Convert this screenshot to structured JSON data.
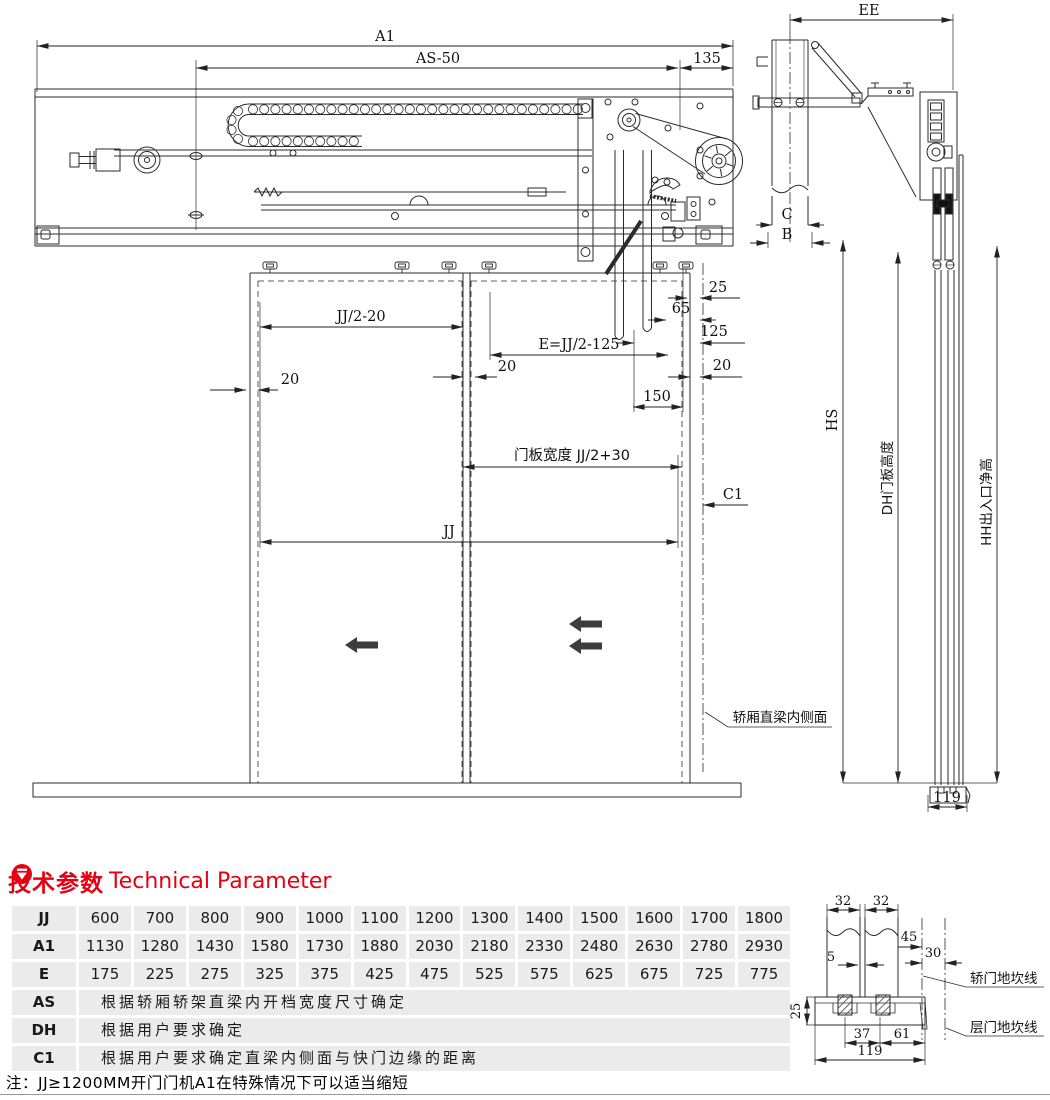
{
  "diagram": {
    "front": {
      "a1": "A1",
      "as_minus_50": "AS-50",
      "n135": "135",
      "jj_half_minus_20": "JJ/2-20",
      "e_formula": "E=JJ/2-125",
      "n25": "25",
      "n65": "65",
      "n125": "125",
      "n20": "20",
      "n150": "150",
      "door_panel_width": "门板宽度 JJ/2+30",
      "c1": "C1",
      "jj": "JJ",
      "car_beam_inner_face": "轿厢直梁内侧面"
    },
    "side": {
      "ee": "EE",
      "c": "C",
      "b": "B",
      "hs": "HS",
      "dh_door_height": "DH门板高度",
      "hh_clear_height": "HH出入口净高",
      "n119": "119"
    },
    "sill": {
      "n32": "32",
      "n45": "45",
      "n30": "30",
      "n5": "5",
      "n25": "25",
      "n37": "37",
      "n61": "61",
      "n119": "119",
      "car_sill_line": "轿门地坎线",
      "landing_sill_line": "层门地坎线"
    }
  },
  "params": {
    "title_zh": "技术参数",
    "title_en": "Technical Parameter",
    "accent_color": "#e60012",
    "note": "注：JJ≥1200MM开门门机A1在特殊情况下可以适当缩短",
    "numeric_rows": [
      {
        "label": "JJ",
        "values": [
          "600",
          "700",
          "800",
          "900",
          "1000",
          "1100",
          "1200",
          "1300",
          "1400",
          "1500",
          "1600",
          "1700",
          "1800"
        ]
      },
      {
        "label": "A1",
        "values": [
          "1130",
          "1280",
          "1430",
          "1580",
          "1730",
          "1880",
          "2030",
          "2180",
          "2330",
          "2480",
          "2630",
          "2780",
          "2930"
        ]
      },
      {
        "label": "E",
        "values": [
          "175",
          "225",
          "275",
          "325",
          "375",
          "425",
          "475",
          "525",
          "575",
          "625",
          "675",
          "725",
          "775"
        ]
      }
    ],
    "text_rows": [
      {
        "label": "AS",
        "text": "根据轿厢轿架直梁内开档宽度尺寸确定"
      },
      {
        "label": "DH",
        "text": "根据用户要求确定"
      },
      {
        "label": "C1",
        "text": "根据用户要求确定直梁内侧面与快门边缘的距离"
      }
    ]
  }
}
